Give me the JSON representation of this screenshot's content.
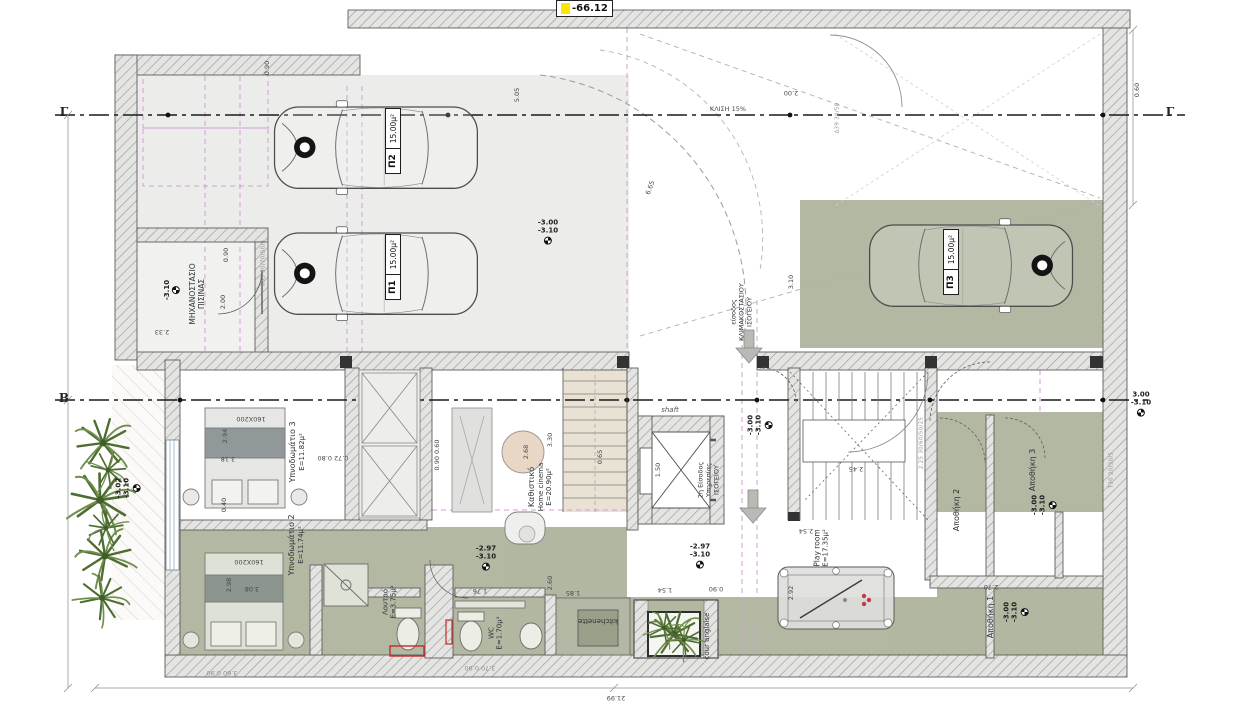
{
  "marker_box": {
    "value": "-66.12"
  },
  "sections": {
    "g": "Γ",
    "b": "Β"
  },
  "cars": [
    {
      "code": "Π2",
      "area": "15.00μ²"
    },
    {
      "code": "Π1",
      "area": "15.00μ²"
    },
    {
      "code": "Π3",
      "area": "15.00μ²"
    }
  ],
  "rooms": [
    {
      "id": "pool-machine-room",
      "l1": "ΜΗΧΑΝΟΣΤΑΣΙΟ",
      "l2": "ΠΙΣΙΝΑΣ"
    },
    {
      "id": "bedroom-3",
      "l1": "Υπνοδωμάτιο 3",
      "l2": "Ε=11.82μ²"
    },
    {
      "id": "living-room",
      "l1": "Καθιστικό",
      "l2": "Home cinema",
      "l3": "Ε=20.90μ²"
    },
    {
      "id": "bedroom-2",
      "l1": "Υπνοδωμάτιο 2",
      "l2": "Ε=11.74μ²"
    },
    {
      "id": "bathroom",
      "l1": "Λουτρό",
      "l2": "Ε=3.75μ²"
    },
    {
      "id": "wc",
      "l1": "WC",
      "l2": "Ε=1.70μ²"
    },
    {
      "id": "kitchenette",
      "l1": "kitchenette"
    },
    {
      "id": "cour-anglaise",
      "l1": "cour anglaise"
    },
    {
      "id": "play-room",
      "l1": "Play room",
      "l2": "Ε=17.35μ²"
    },
    {
      "id": "storage-2",
      "l1": "Αποθήκη 2"
    },
    {
      "id": "storage-3",
      "l1": "Αποθήκη 3"
    },
    {
      "id": "storage-1",
      "l1": "Αποθήκη 1"
    },
    {
      "id": "shaft",
      "l1": "shaft"
    },
    {
      "id": "entrance-2",
      "l1": "2η Είσοδος",
      "l2": "Υπηρεσίας",
      "l3": "ΙΣΟΓΕΙΟΥ"
    },
    {
      "id": "entrance-1",
      "l1": "είσοδος",
      "l2": "ΚΛΙΜΑΚΟΣΤΑΣΙΟΥ",
      "l3": "ΙΣΟΓΕΙΟΥ"
    }
  ],
  "levels": [
    {
      "id": "garage",
      "l1": "-3.00",
      "l2": "-3.10"
    },
    {
      "id": "mech-room",
      "l1": "-3.10",
      "l2": ""
    },
    {
      "id": "walkway",
      "l1": "-3.02",
      "l2": "-3.10"
    },
    {
      "id": "entry-2",
      "l1": "-3.00",
      "l2": "-3.10"
    },
    {
      "id": "storage-3",
      "l1": "-3.00",
      "l2": "-3.10"
    },
    {
      "id": "storage-1",
      "l1": "-3.00",
      "l2": "-3.10"
    },
    {
      "id": "bath-zone",
      "l1": "-2.97",
      "l2": "-3.10"
    },
    {
      "id": "court-zone",
      "l1": "-2.97",
      "l2": "-3.10"
    },
    {
      "id": "section-b-end",
      "l1": "3.00",
      "l2": "-3.10"
    }
  ],
  "dims": [
    {
      "t": "2.00"
    },
    {
      "t": "2.33"
    },
    {
      "t": "0.90"
    },
    {
      "t": "2.00"
    },
    {
      "t": "3.10"
    },
    {
      "t": "6.65"
    },
    {
      "t": "2.94"
    },
    {
      "t": "3.18"
    },
    {
      "t": "160X200"
    },
    {
      "t": "0.40"
    },
    {
      "t": "2.98"
    },
    {
      "t": "3.08"
    },
    {
      "t": "160X200"
    },
    {
      "t": "0.72  0.80"
    },
    {
      "t": "0.90  0.60"
    },
    {
      "t": "2.68"
    },
    {
      "t": "3.30"
    },
    {
      "t": "0.65"
    },
    {
      "t": "1.50"
    },
    {
      "t": "2.45"
    },
    {
      "t": "2.54"
    },
    {
      "t": "1.76"
    },
    {
      "t": "2.60"
    },
    {
      "t": "1.85"
    },
    {
      "t": "1.54"
    },
    {
      "t": "0.90"
    },
    {
      "t": "0.60"
    },
    {
      "t": "5.05"
    },
    {
      "t": "21.99"
    },
    {
      "t": "3.60  0.90"
    },
    {
      "t": "3.70  0.90"
    },
    {
      "t": "2.70"
    },
    {
      "t": "0.90"
    },
    {
      "t": "2.92"
    }
  ],
  "annotations": [
    {
      "t": "ΚΛΙΣΗ 15%"
    },
    {
      "t": "Δ39 30/50"
    },
    {
      "t": "Κ65 30/70/50/5"
    },
    {
      "t": "2.25 30/60/50/25"
    },
    {
      "t": "Τ30 20/30/5"
    }
  ]
}
